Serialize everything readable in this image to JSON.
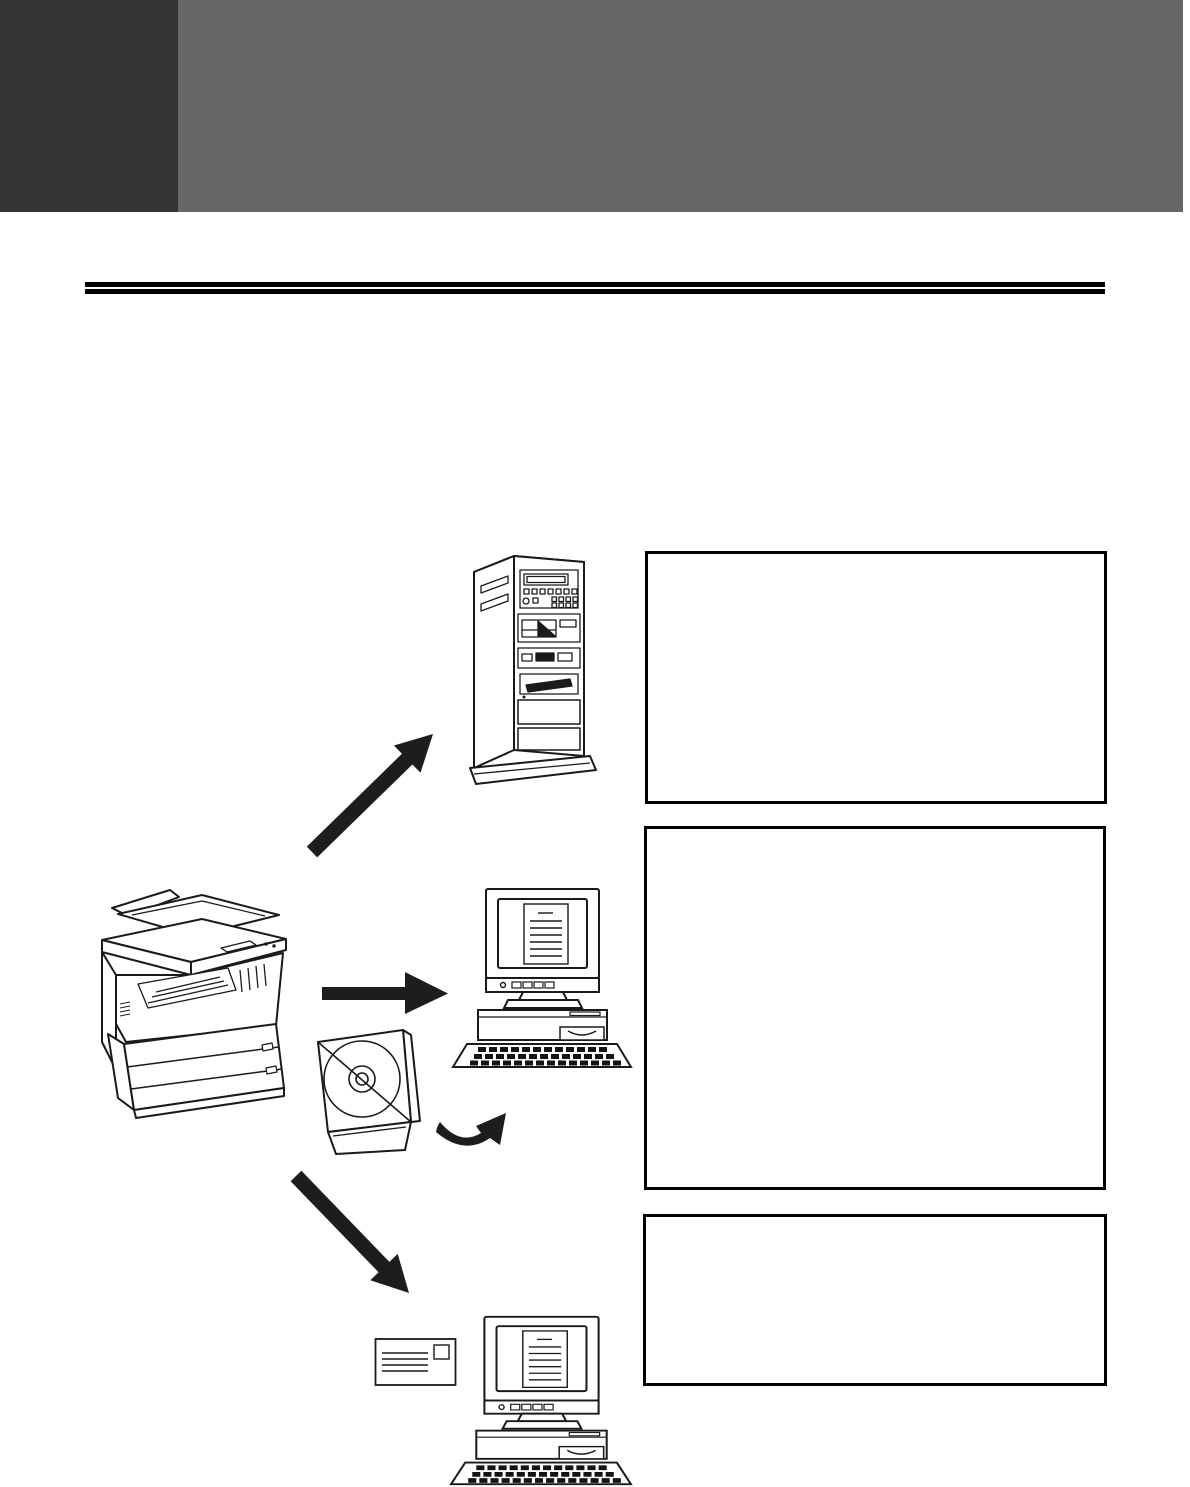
{
  "page": {
    "background_color": "#ffffff",
    "line_art_color": "#1a1a1a"
  },
  "header": {
    "dark_tab_color": "#333333",
    "banner_color": "#666666"
  },
  "title_rule": {
    "style": "double",
    "color": "#000000"
  },
  "callouts": [
    {
      "name": "server-callout",
      "text": ""
    },
    {
      "name": "desktop-callout",
      "text": ""
    },
    {
      "name": "email-callout",
      "text": ""
    }
  ],
  "figures": {
    "copier": {
      "label": "digital multifunction copier with document feeder"
    },
    "server": {
      "label": "network server tower"
    },
    "desktop_top": {
      "label": "desktop computer with CRT monitor and keyboard showing a scanned document"
    },
    "cd": {
      "label": "open CD jewel case with disc"
    },
    "envelope": {
      "label": "mail envelope with address lines and stamp"
    },
    "desktop_bottom": {
      "label": "desktop computer with CRT monitor and keyboard showing a scanned document"
    }
  },
  "arrows": {
    "to_server": {
      "direction": "up-right"
    },
    "to_desktop": {
      "direction": "right"
    },
    "cd_to_desktop": {
      "direction": "curved-up-right"
    },
    "to_email": {
      "direction": "down-right"
    }
  }
}
